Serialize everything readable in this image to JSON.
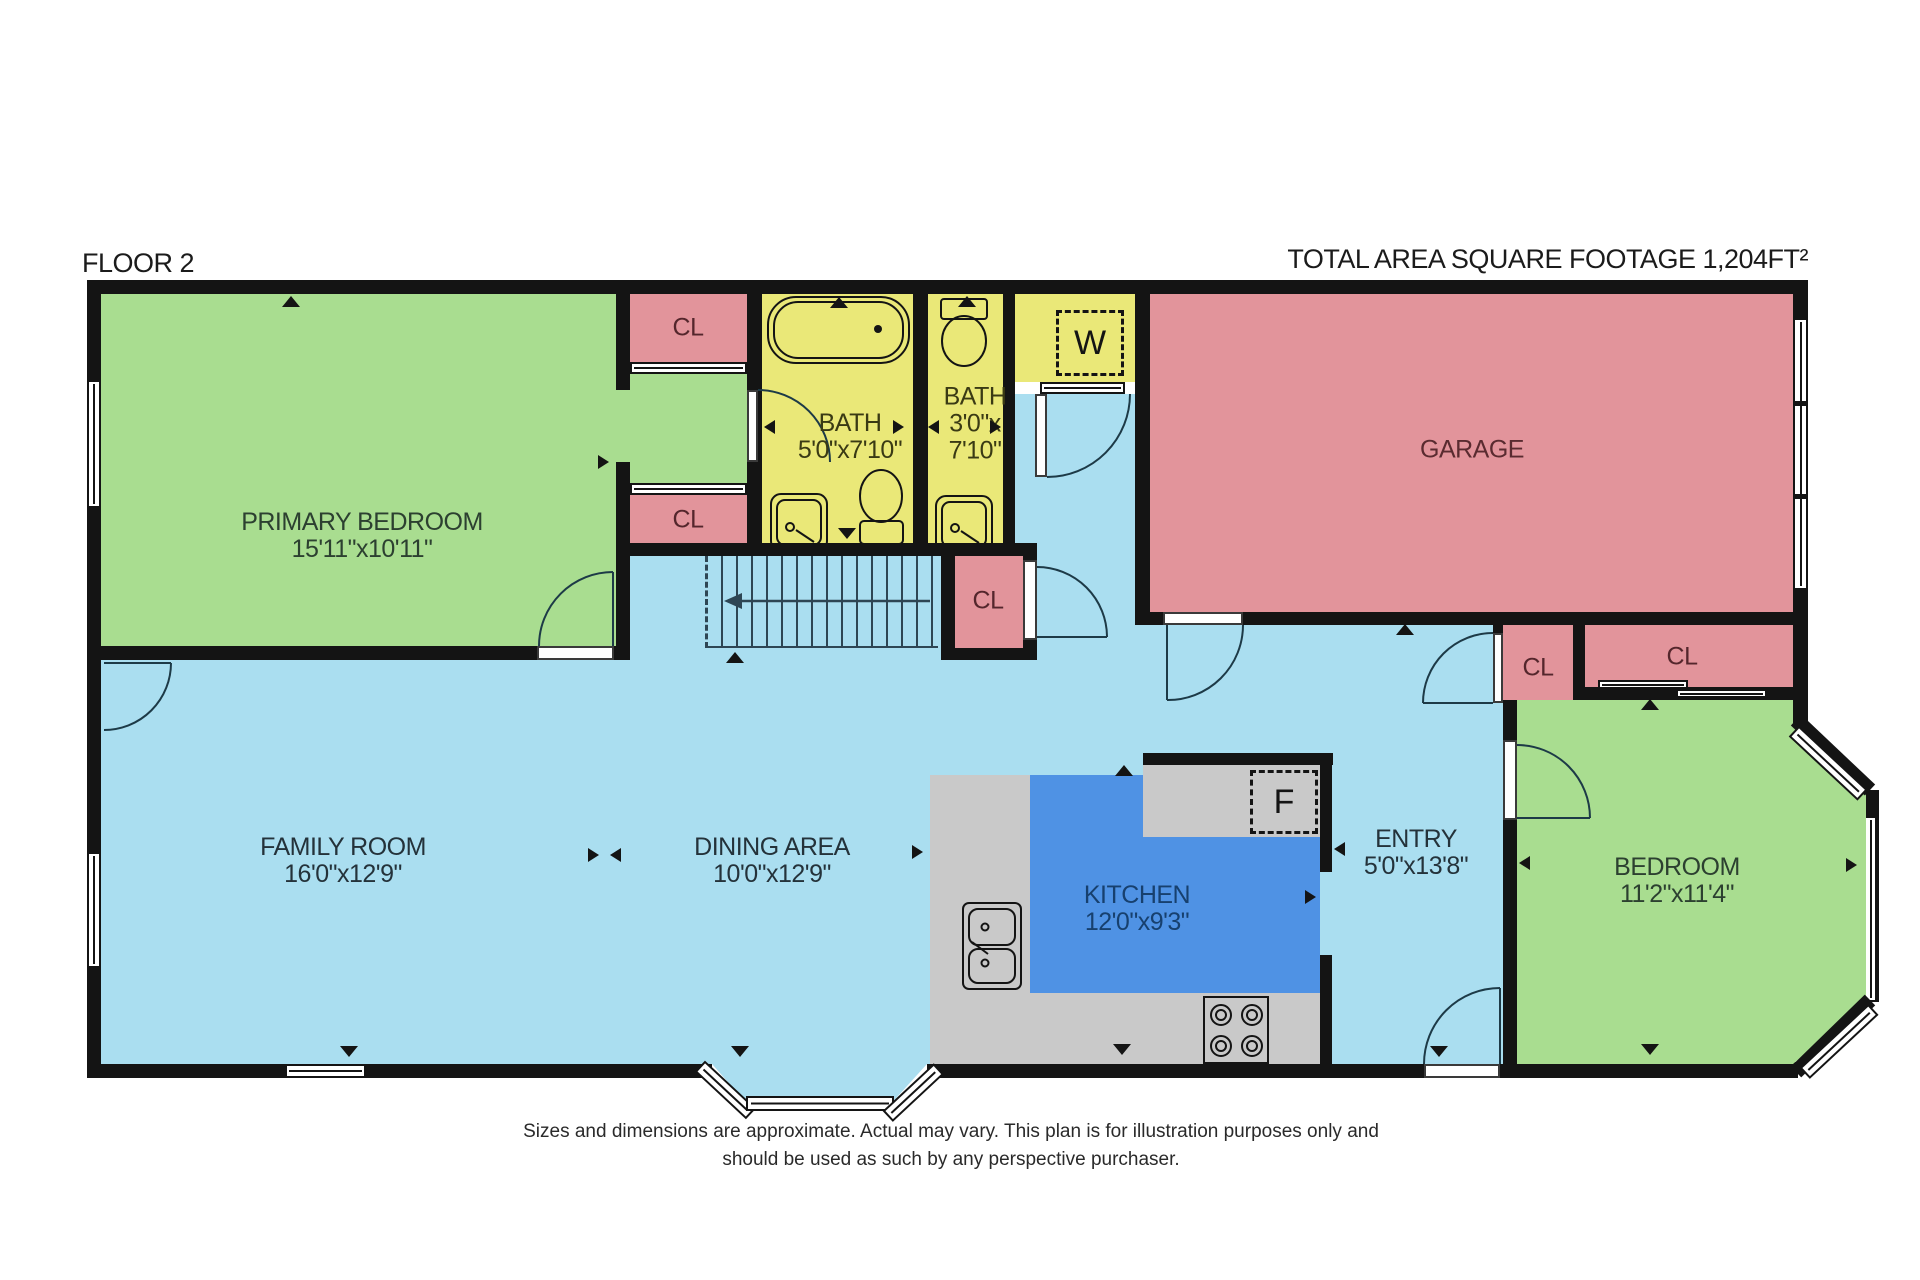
{
  "header": {
    "floor_label": "FLOOR 2",
    "total_area": "TOTAL AREA SQUARE FOOTAGE 1,204FT²"
  },
  "rooms": {
    "primary_bedroom": {
      "name": "PRIMARY BEDROOM",
      "dims": "15'11\"x10'11\""
    },
    "bath1": {
      "name": "BATH",
      "dims": "5'0\"x7'10\""
    },
    "bath2": {
      "name": "BATH",
      "dims_line1": "3'0\"x",
      "dims_line2": "7'10\""
    },
    "garage": {
      "name": "GARAGE"
    },
    "family_room": {
      "name": "FAMILY ROOM",
      "dims": "16'0\"x12'9\""
    },
    "dining_area": {
      "name": "DINING AREA",
      "dims": "10'0\"x12'9\""
    },
    "kitchen": {
      "name": "KITCHEN",
      "dims": "12'0\"x9'3\""
    },
    "entry": {
      "name": "ENTRY",
      "dims": "5'0\"x13'8\""
    },
    "bedroom": {
      "name": "BEDROOM",
      "dims": "11'2\"x11'4\""
    }
  },
  "closets": {
    "cl_top": "CL",
    "cl_bottom": "CL",
    "cl_stairs": "CL",
    "cl_entry": "CL",
    "cl_bedroom": "CL"
  },
  "appliances": {
    "washer": "W",
    "fridge": "F"
  },
  "disclaimer": {
    "line1": "Sizes and dimensions are approximate. Actual may vary. This plan is for illustration purposes only and",
    "line2": "should be used as such by any perspective purchaser."
  },
  "colors": {
    "wall": "#141414",
    "bedroom_green": "#a9dd90",
    "closet_pink": "#e2949b",
    "bath_yellow": "#eae878",
    "floor_blue": "#aadef0",
    "kitchen_blue": "#4f92e4",
    "counter_gray": "#c9c9c9"
  }
}
